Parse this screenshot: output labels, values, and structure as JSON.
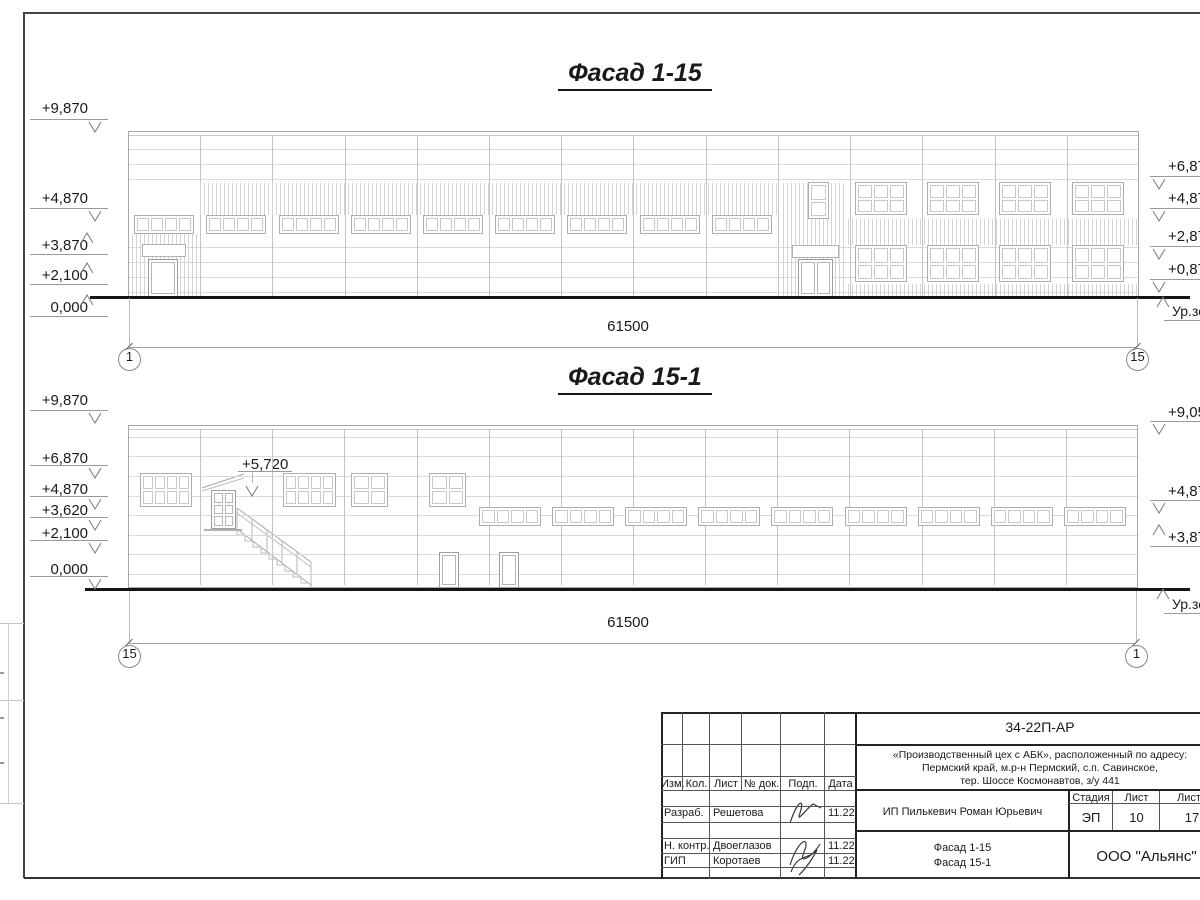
{
  "drawing": {
    "facade1": {
      "title": "Фасад 1-15",
      "dimension": "61500",
      "axis_left": "1",
      "axis_right": "15",
      "marks_left": [
        "+9,870",
        "+4,870",
        "+3,870",
        "+2,100",
        "0,000"
      ],
      "marks_right": [
        "+6,87",
        "+4,87",
        "+2,87",
        "+0,87"
      ],
      "ground_label": "Ур.зе"
    },
    "facade2": {
      "title": "Фасад 15-1",
      "dimension": "61500",
      "axis_left": "15",
      "axis_right": "1",
      "marks_left": [
        "+9,870",
        "+6,870",
        "+4,870",
        "+3,620",
        "+2,100",
        "0,000"
      ],
      "marks_right": [
        "+9,05",
        "+4,87",
        "+3,87"
      ],
      "stair_mark": "+5,720",
      "ground_label": "Ур.зе"
    }
  },
  "titleblock": {
    "doc_code": "34-22П-АР",
    "project_address_line1": "«Производственный цех с АБК», расположенный по адресу:",
    "project_address_line2": "Пермский край, м.р-н Пермский, с.п. Савинское,",
    "project_address_line3": "тер. Шоссе Космонавтов, з/у 441",
    "columns": [
      "Изм.",
      "Кол.",
      "Лист",
      "№ док.",
      "Подп.",
      "Дата"
    ],
    "signature_rows": [
      {
        "role": "Разраб.",
        "name": "Решетова",
        "date": "11.22"
      },
      {
        "role": "Н. контр.",
        "name": "Двоеглазов",
        "date": "11.22"
      },
      {
        "role": "ГИП",
        "name": "Коротаев",
        "date": "11.22"
      }
    ],
    "client": "ИП Пилькевич Роман Юрьевич",
    "stage_label": "Стадия",
    "stage_value": "ЭП",
    "sheet_label": "Лист",
    "sheet_value": "10",
    "sheets_label": "Листо",
    "sheets_value": "17",
    "drawing_name_line1": "Фасад 1-15",
    "drawing_name_line2": "Фасад 15-1",
    "company": "ООО \"Альянс\""
  }
}
